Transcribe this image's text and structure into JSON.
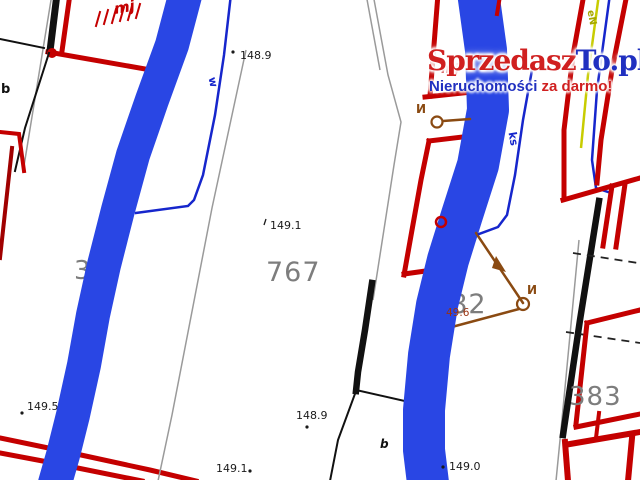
{
  "watermark": {
    "brand_red": "Sprzedasz",
    "brand_blue": "To.pl",
    "tagline_blue": "Nieruchomości",
    "tagline_red": " za darmo!"
  },
  "parcel_numbers": {
    "p767": "767",
    "p382": "382",
    "p383": "383",
    "p3": "3"
  },
  "elevation_points": {
    "top": "148.9",
    "center": "149.1",
    "bottom_center": "148.9",
    "bottom_left_of_center": "149.1",
    "bottom_right": "149.0",
    "bottom_left": "149.5",
    "near_382": "49.6"
  },
  "annotations": {
    "b_left": "b",
    "b_bottom": "b",
    "water_line": "w",
    "sewer_line": "ks",
    "power_line": "eN",
    "pole_1": "И",
    "pole_2": "И",
    "mj_top": "mj",
    "mj_center": "mj"
  },
  "colors": {
    "river": "#2946e4",
    "red": "#c40000",
    "dark_red": "#a00000",
    "brown": "#8a4a12",
    "gray_line": "#9a9a9a",
    "parcel_gray": "#7d7d7d",
    "blue_line": "#1626cc",
    "yellow_line": "#c8cc00",
    "label": "#1a1a1a",
    "wm_red": "#d02020",
    "wm_blue": "#2030c0",
    "near_382_color": "#993311"
  }
}
